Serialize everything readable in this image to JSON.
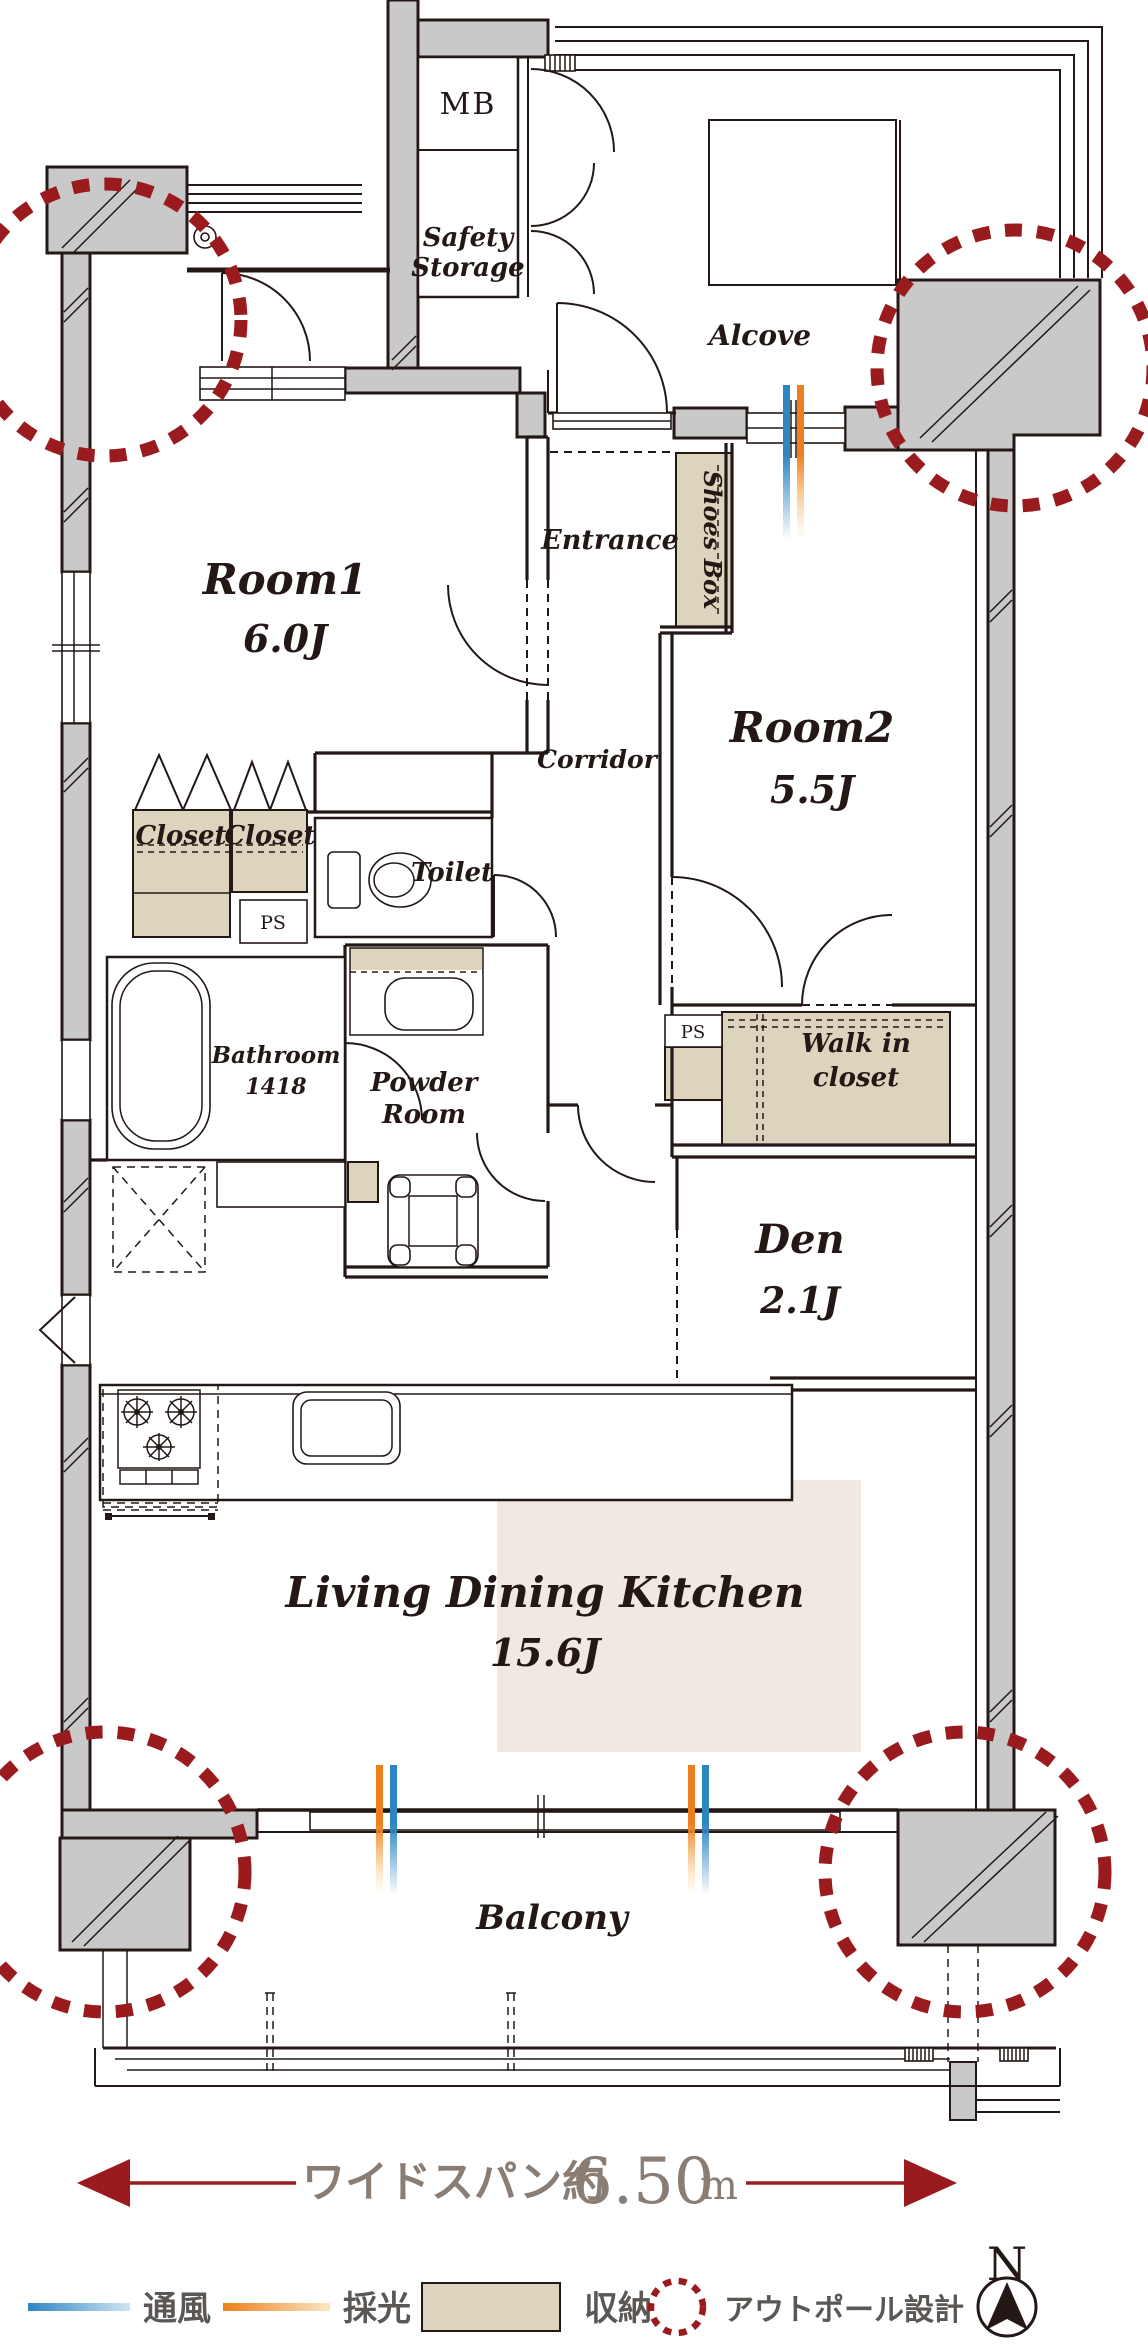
{
  "colors": {
    "wall_gray": "#c9c9c9",
    "line_dark": "#231815",
    "storage_beige": "#ddd4bd",
    "ldk_pink": "#f2e8e2",
    "outpole_red": "#9a1b1e",
    "dimension_red": "#9a1b1e",
    "dimension_text_gray": "#8a7d74",
    "legend_text_gray": "#5a5754",
    "vent_blue": "#2e86c1",
    "daylight_orange": "#ee7f1f"
  },
  "rooms": {
    "mb": "MB",
    "safety_storage": {
      "line1": "Safety",
      "line2": "Storage"
    },
    "alcove": "Alcove",
    "entrance": "Entrance",
    "shoes_box": "Shoes Box",
    "room1": {
      "name": "Room1",
      "size": "6.0J"
    },
    "corridor": "Corridor",
    "room2": {
      "name": "Room2",
      "size": "5.5J"
    },
    "closet_left": "Closet",
    "closet_right": "Closet",
    "ps_upper": "PS",
    "ps_lower": "PS",
    "toilet": "Toilet",
    "bathroom": {
      "name": "Bathroom",
      "size": "1418"
    },
    "powder_room": {
      "line1": "Powder",
      "line2": "Room"
    },
    "walk_in_closet": {
      "line1": "Walk in",
      "line2": "closet"
    },
    "den": {
      "name": "Den",
      "size": "2.1J"
    },
    "ldk": {
      "name": "Living Dining Kitchen",
      "size": "15.6J"
    },
    "balcony": "Balcony"
  },
  "dimension": {
    "prefix": "ワイドスパン約",
    "value": "6.50",
    "unit": "m"
  },
  "legend": {
    "vent": "通風",
    "daylight": "採光",
    "storage": "収納",
    "outpole": "アウトポール設計"
  },
  "compass": {
    "north": "N"
  }
}
